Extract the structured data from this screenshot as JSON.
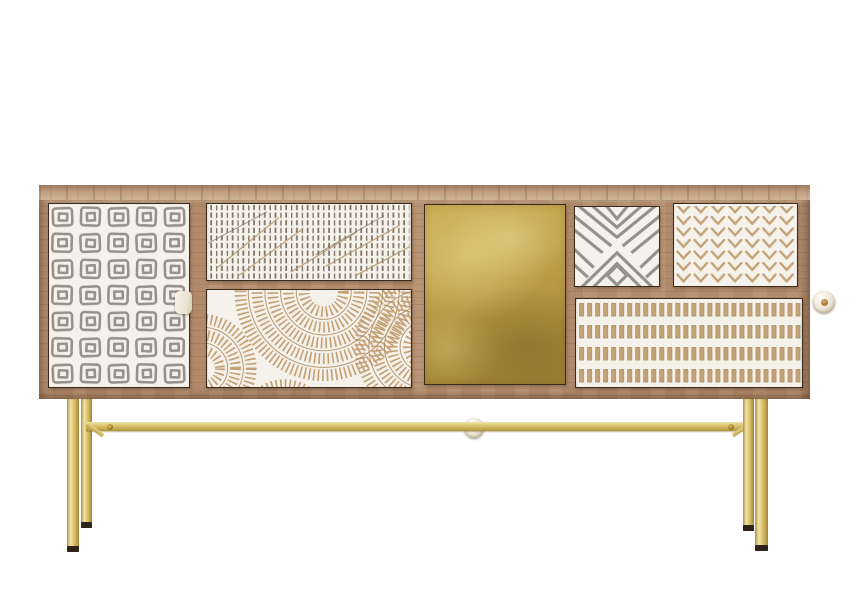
{
  "scene": {
    "type": "product-photograph",
    "subject": "boho mango-wood sideboard with seven patterned fronts and brass hairpin-frame legs",
    "background_color": "#ffffff"
  },
  "colors": {
    "wood_frame": "#b18a6b",
    "wood_top": "#c09d7e",
    "panel_white": "#f5f2ec",
    "pattern_gray": "#96918a",
    "hatch_gray": "#7d7263",
    "carve_tan": "#c4a176",
    "streak_tan": "#bb9c72",
    "brass_door": "#bfa14b",
    "brass_leg": "#d9c472",
    "knob_white": "#f3efe5",
    "cutout_black": "#14100c",
    "foot_cap": "#2f241a"
  },
  "cabinet": {
    "panels": [
      {
        "id": "left-door",
        "pattern": "hand-drawn concentric squares, gray on white",
        "handle": "small white rectangular knob on right edge"
      },
      {
        "id": "top-middle-drawer",
        "pattern": "dense rows of vertical hatch marks",
        "handle": "half-moon cut-out"
      },
      {
        "id": "middle-drawer",
        "pattern": "carved fan arcs / tree rings, tan on white",
        "handle": "round white knob"
      },
      {
        "id": "center-door",
        "pattern": "plain hammered brass sheet",
        "handle": "round white knob with brass center"
      },
      {
        "id": "small-drawer-x",
        "pattern": "gray chevron X motif on white",
        "handle": "none visible"
      },
      {
        "id": "small-drawer-herringbone",
        "pattern": "carved herringbone columns, tan on white",
        "handle": "round white knob"
      },
      {
        "id": "bottom-right-drawer",
        "pattern": "four rows of carved vertical dashes, tan on white",
        "handle": "round two-tone knob"
      }
    ],
    "base": {
      "legs": 4,
      "material": "brass",
      "stretcher_bar": true,
      "foot_caps": "dark brown"
    }
  }
}
